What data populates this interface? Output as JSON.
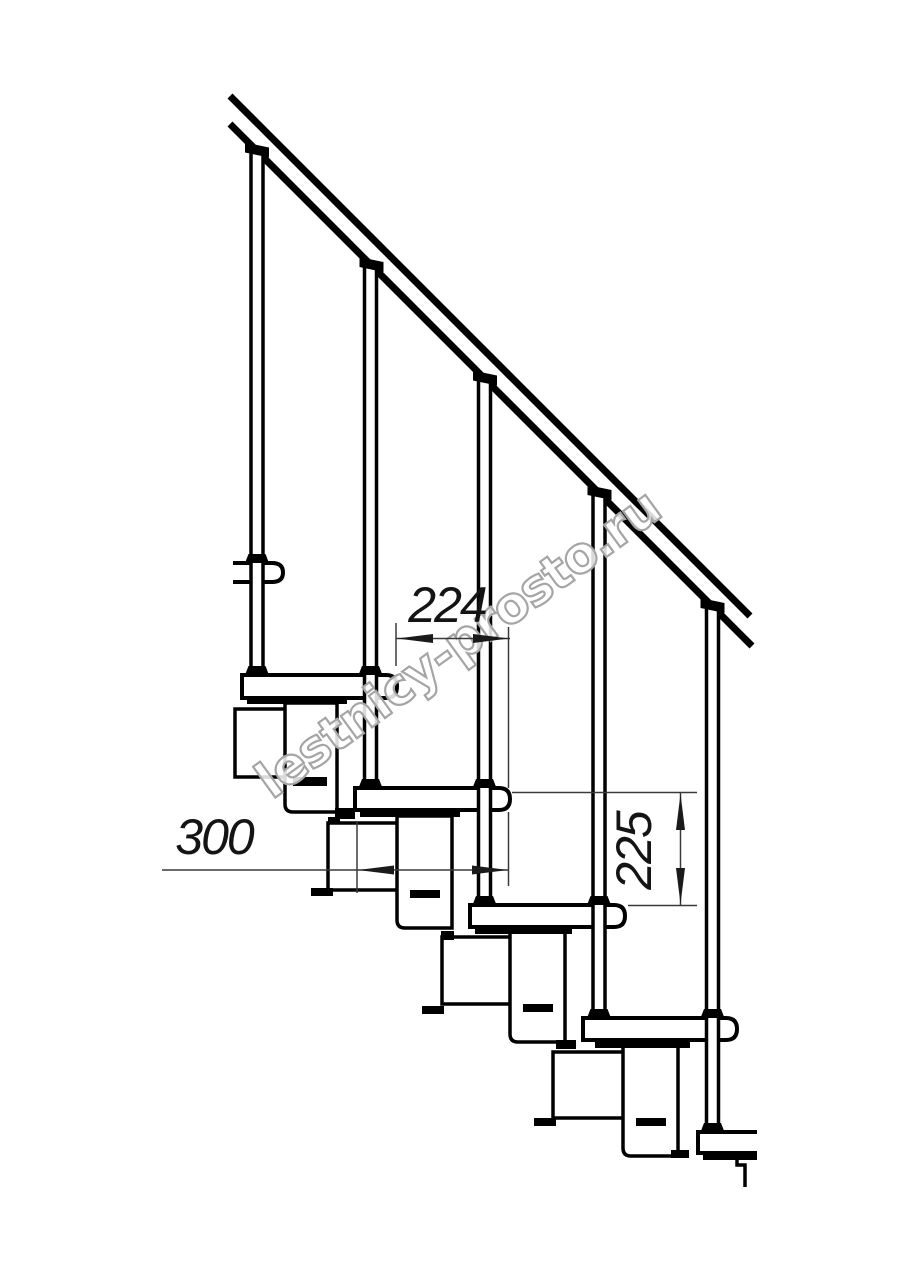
{
  "page": {
    "background": "#ffffff"
  },
  "drawing": {
    "subject": "modular staircase side view technical drawing",
    "line_color": "#000000",
    "dimension_line_color": "#3a3a3a",
    "dimension_text_color": "#141414",
    "watermark_color": "#a5a5a5",
    "treads_visible": 5,
    "balusters_visible": 5,
    "handrail": "diagonal double-line handrail"
  },
  "dimensions": {
    "run": "224",
    "depth": "300",
    "rise": "225"
  },
  "watermark": {
    "text": "lestnicy-prosto.ru"
  }
}
